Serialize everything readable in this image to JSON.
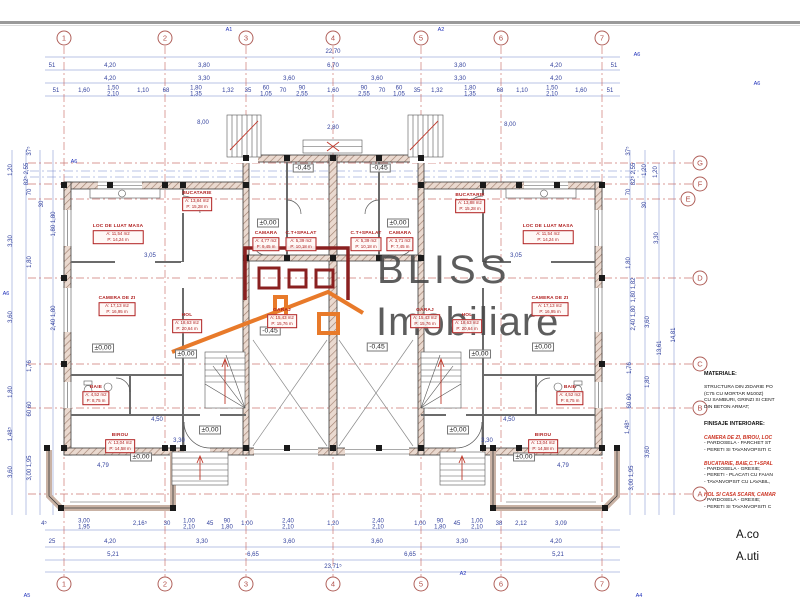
{
  "colors": {
    "grid_red": "#c4625c",
    "dim_blue": "#33429e",
    "label_red": "#b02020",
    "logo_orange": "#e87a2a",
    "logo_darkred": "#8a2020",
    "watermark_gray": "#474747"
  },
  "watermark": {
    "line1": "BLISS",
    "line2": "Imobiliare"
  },
  "grid": {
    "top_y": 38,
    "bottom_y": 584,
    "right_x": 700,
    "cols": [
      {
        "n": "1",
        "x": 64
      },
      {
        "n": "2",
        "x": 165
      },
      {
        "n": "3",
        "x": 246
      },
      {
        "n": "4",
        "x": 333
      },
      {
        "n": "5",
        "x": 421
      },
      {
        "n": "6",
        "x": 501
      },
      {
        "n": "7",
        "x": 602
      }
    ],
    "rows": [
      {
        "n": "G",
        "y": 163
      },
      {
        "n": "F",
        "y": 184
      },
      {
        "n": "E",
        "y": 199,
        "bx": 688
      },
      {
        "n": "D",
        "y": 278
      },
      {
        "n": "C",
        "y": 364
      },
      {
        "n": "B",
        "y": 408
      },
      {
        "n": "A",
        "y": 494
      }
    ]
  },
  "rooms": [
    {
      "name": "BUCATARIE",
      "a": "A: 13,84 m2",
      "p": "P: 15,28 m",
      "x": 197,
      "y": 201
    },
    {
      "name": "BUCATARIE",
      "a": "A: 13,88 m2",
      "p": "P: 15,28 m",
      "x": 470,
      "y": 203
    },
    {
      "name": "LOC DE LUAT MASA",
      "a": "A: 11,54 m2",
      "p": "P: 14,24 m",
      "x": 118,
      "y": 234
    },
    {
      "name": "LOC DE LUAT MASA",
      "a": "A: 11,54 m2",
      "p": "P: 14,24 m",
      "x": 548,
      "y": 234
    },
    {
      "name": "CAMARA",
      "a": "A: 4,77 m2",
      "p": "P: 9,45 m",
      "x": 266,
      "y": 241
    },
    {
      "name": "C.T+SPALAT",
      "a": "A: 5,39 m2",
      "p": "P: 10,18 m",
      "x": 301,
      "y": 241
    },
    {
      "name": "C.T+SPALAT",
      "a": "A: 5,39 m2",
      "p": "P: 10,18 m",
      "x": 366,
      "y": 241
    },
    {
      "name": "CAMARA",
      "a": "A: 3,71 m2",
      "p": "P: 7,45 m",
      "x": 400,
      "y": 241
    },
    {
      "name": "CAMERA DE ZI",
      "a": "A: 17,13 m2",
      "p": "P: 16,95 m",
      "x": 117,
      "y": 306
    },
    {
      "name": "CAMERA DE ZI",
      "a": "A: 17,13 m2",
      "p": "P: 16,95 m",
      "x": 550,
      "y": 306
    },
    {
      "name": "HOL",
      "a": "A: 18,63 m2",
      "p": "P: 20,64 m",
      "x": 187,
      "y": 323
    },
    {
      "name": "HOL",
      "a": "A: 18,63 m2",
      "p": "P: 20,64 m",
      "x": 467,
      "y": 323
    },
    {
      "name": "GARAJ",
      "a": "A: 15,43 m2",
      "p": "P: 15,76 m",
      "x": 282,
      "y": 318
    },
    {
      "name": "GARAJ",
      "a": "A: 15,43 m2",
      "p": "P: 15,76 m",
      "x": 425,
      "y": 318
    },
    {
      "name": "BAIE",
      "a": "A: 4,52 m2",
      "p": "P: 8,75 m",
      "x": 96,
      "y": 395
    },
    {
      "name": "BAIE",
      "a": "A: 4,52 m2",
      "p": "P: 8,75 m",
      "x": 570,
      "y": 395
    },
    {
      "name": "BIROU",
      "a": "A: 13,04 m2",
      "p": "P: 14,58 m",
      "x": 120,
      "y": 443
    },
    {
      "name": "BIROU",
      "a": "A: 13,04 m2",
      "p": "P: 14,58 m",
      "x": 543,
      "y": 443
    }
  ],
  "elevations": [
    {
      "t": "±0,00",
      "x": 103,
      "y": 348
    },
    {
      "t": "±0,00",
      "x": 186,
      "y": 354
    },
    {
      "t": "±0,00",
      "x": 543,
      "y": 347
    },
    {
      "t": "±0,00",
      "x": 480,
      "y": 354
    },
    {
      "t": "±0,00",
      "x": 268,
      "y": 223
    },
    {
      "t": "±0,00",
      "x": 398,
      "y": 223
    },
    {
      "t": "±0,00",
      "x": 210,
      "y": 430
    },
    {
      "t": "±0,00",
      "x": 458,
      "y": 430
    },
    {
      "t": "±0,00",
      "x": 141,
      "y": 457
    },
    {
      "t": "±0,00",
      "x": 524,
      "y": 457
    },
    {
      "t": "-0,45",
      "x": 303,
      "y": 168
    },
    {
      "t": "-0,45",
      "x": 380,
      "y": 168
    },
    {
      "t": "-0,45",
      "x": 270,
      "y": 331
    },
    {
      "t": "-0,45",
      "x": 377,
      "y": 347
    }
  ],
  "dimensions": [
    {
      "x": 333,
      "y": 52,
      "t": "22,70"
    },
    {
      "x": 52,
      "y": 66,
      "t": "51"
    },
    {
      "x": 110,
      "y": 66,
      "t": "4,20"
    },
    {
      "x": 204,
      "y": 66,
      "t": "3,80"
    },
    {
      "x": 333,
      "y": 66,
      "t": "6,70"
    },
    {
      "x": 460,
      "y": 66,
      "t": "3,80"
    },
    {
      "x": 556,
      "y": 66,
      "t": "4,20"
    },
    {
      "x": 614,
      "y": 66,
      "t": "51"
    },
    {
      "x": 110,
      "y": 79,
      "t": "4,20"
    },
    {
      "x": 204,
      "y": 79,
      "t": "3,30"
    },
    {
      "x": 289,
      "y": 79,
      "t": "3,60"
    },
    {
      "x": 377,
      "y": 79,
      "t": "3,60"
    },
    {
      "x": 460,
      "y": 79,
      "t": "3,30"
    },
    {
      "x": 556,
      "y": 79,
      "t": "4,20"
    },
    {
      "x": 56,
      "y": 91,
      "t": "51"
    },
    {
      "x": 84,
      "y": 91,
      "t": "1,60"
    },
    {
      "x": 113,
      "y": 92,
      "t": "1,50\n2,10"
    },
    {
      "x": 143,
      "y": 91,
      "t": "1,10"
    },
    {
      "x": 166,
      "y": 91,
      "t": "68"
    },
    {
      "x": 196,
      "y": 92,
      "t": "1,80\n1,35"
    },
    {
      "x": 228,
      "y": 91,
      "t": "1,32"
    },
    {
      "x": 248,
      "y": 91,
      "t": "35"
    },
    {
      "x": 266,
      "y": 92,
      "t": "60\n1,05"
    },
    {
      "x": 283,
      "y": 91,
      "t": "70"
    },
    {
      "x": 302,
      "y": 92,
      "t": "90\n2,55"
    },
    {
      "x": 333,
      "y": 91,
      "t": "1,60"
    },
    {
      "x": 364,
      "y": 92,
      "t": "90\n2,55"
    },
    {
      "x": 382,
      "y": 91,
      "t": "70"
    },
    {
      "x": 399,
      "y": 92,
      "t": "60\n1,05"
    },
    {
      "x": 417,
      "y": 91,
      "t": "35"
    },
    {
      "x": 437,
      "y": 91,
      "t": "1,32"
    },
    {
      "x": 470,
      "y": 92,
      "t": "1,80\n1,35"
    },
    {
      "x": 500,
      "y": 91,
      "t": "68"
    },
    {
      "x": 522,
      "y": 91,
      "t": "1,10"
    },
    {
      "x": 552,
      "y": 92,
      "t": "1,50\n2,10"
    },
    {
      "x": 581,
      "y": 91,
      "t": "1,60"
    },
    {
      "x": 610,
      "y": 91,
      "t": "51"
    },
    {
      "x": 203,
      "y": 123,
      "t": "8,00"
    },
    {
      "x": 510,
      "y": 125,
      "t": "8,00"
    },
    {
      "x": 333,
      "y": 128,
      "t": "2,80"
    },
    {
      "x": 150,
      "y": 256,
      "t": "3,05"
    },
    {
      "x": 516,
      "y": 256,
      "t": "3,05"
    },
    {
      "x": 157,
      "y": 420,
      "t": "4,50"
    },
    {
      "x": 509,
      "y": 420,
      "t": "4,50"
    },
    {
      "x": 179,
      "y": 441,
      "t": "3,30"
    },
    {
      "x": 487,
      "y": 441,
      "t": "3,30"
    },
    {
      "x": 103,
      "y": 466,
      "t": "4,79"
    },
    {
      "x": 563,
      "y": 466,
      "t": "4,79"
    },
    {
      "x": 44,
      "y": 524,
      "t": "4⁵"
    },
    {
      "x": 84,
      "y": 525,
      "t": "3,00\n1,95"
    },
    {
      "x": 140,
      "y": 524,
      "t": "2,16⁵"
    },
    {
      "x": 167,
      "y": 524,
      "t": "30"
    },
    {
      "x": 189,
      "y": 525,
      "t": "1,00\n2,10"
    },
    {
      "x": 210,
      "y": 524,
      "t": "45"
    },
    {
      "x": 227,
      "y": 525,
      "t": "90\n1,80"
    },
    {
      "x": 247,
      "y": 524,
      "t": "1,00"
    },
    {
      "x": 288,
      "y": 525,
      "t": "2,40\n2,10"
    },
    {
      "x": 333,
      "y": 524,
      "t": "1,20"
    },
    {
      "x": 378,
      "y": 525,
      "t": "2,40\n2,10"
    },
    {
      "x": 420,
      "y": 524,
      "t": "1,00"
    },
    {
      "x": 440,
      "y": 525,
      "t": "90\n1,80"
    },
    {
      "x": 457,
      "y": 524,
      "t": "45"
    },
    {
      "x": 477,
      "y": 525,
      "t": "1,00\n2,10"
    },
    {
      "x": 499,
      "y": 524,
      "t": "38"
    },
    {
      "x": 521,
      "y": 524,
      "t": "2,12"
    },
    {
      "x": 561,
      "y": 524,
      "t": "3,09"
    },
    {
      "x": 52,
      "y": 542,
      "t": "25"
    },
    {
      "x": 110,
      "y": 542,
      "t": "4,20"
    },
    {
      "x": 202,
      "y": 542,
      "t": "3,30"
    },
    {
      "x": 289,
      "y": 542,
      "t": "3,60"
    },
    {
      "x": 377,
      "y": 542,
      "t": "3,60"
    },
    {
      "x": 462,
      "y": 542,
      "t": "3,30"
    },
    {
      "x": 556,
      "y": 542,
      "t": "4,20"
    },
    {
      "x": 113,
      "y": 555,
      "t": "5,21"
    },
    {
      "x": 253,
      "y": 555,
      "t": "6,65"
    },
    {
      "x": 410,
      "y": 555,
      "t": "6,65"
    },
    {
      "x": 558,
      "y": 555,
      "t": "5,21"
    },
    {
      "x": 333,
      "y": 567,
      "t": "23,71⁵"
    },
    {
      "x": 30,
      "y": 151,
      "t": "37⁵",
      "r": 1
    },
    {
      "x": 27,
      "y": 174,
      "t": "82⁵ 2,55",
      "r": 1
    },
    {
      "x": 11,
      "y": 170,
      "t": "1,20",
      "r": 1
    },
    {
      "x": 30,
      "y": 192,
      "t": "70",
      "r": 1
    },
    {
      "x": 42,
      "y": 204,
      "t": "30",
      "r": 1
    },
    {
      "x": 54,
      "y": 224,
      "t": "1,80 1,80",
      "r": 1
    },
    {
      "x": 11,
      "y": 241,
      "t": "3,30",
      "r": 1
    },
    {
      "x": 30,
      "y": 262,
      "t": "1,80",
      "r": 1
    },
    {
      "x": 54,
      "y": 318,
      "t": "2,40 1,80",
      "r": 1
    },
    {
      "x": 11,
      "y": 317,
      "t": "3,60",
      "r": 1
    },
    {
      "x": 30,
      "y": 366,
      "t": "1,76",
      "r": 1
    },
    {
      "x": 11,
      "y": 392,
      "t": "1,80",
      "r": 1
    },
    {
      "x": 30,
      "y": 409,
      "t": "60 60",
      "r": 1
    },
    {
      "x": 11,
      "y": 434,
      "t": "1,48⁵",
      "r": 1
    },
    {
      "x": 30,
      "y": 468,
      "t": "3,00 1,95",
      "r": 1
    },
    {
      "x": 11,
      "y": 472,
      "t": "3,60",
      "r": 1
    },
    {
      "x": 629,
      "y": 151,
      "t": "37⁵",
      "r": 1
    },
    {
      "x": 634,
      "y": 174,
      "t": "82⁵ 2,55",
      "r": 1
    },
    {
      "x": 645,
      "y": 170,
      "t": "1,20",
      "r": 1
    },
    {
      "x": 656,
      "y": 172,
      "t": "1,20",
      "r": 1
    },
    {
      "x": 629,
      "y": 192,
      "t": "70",
      "r": 1
    },
    {
      "x": 645,
      "y": 205,
      "t": "30",
      "r": 1
    },
    {
      "x": 634,
      "y": 290,
      "t": "1,80 1,82",
      "r": 1
    },
    {
      "x": 657,
      "y": 238,
      "t": "3,30",
      "r": 1
    },
    {
      "x": 629,
      "y": 263,
      "t": "1,80",
      "r": 1
    },
    {
      "x": 634,
      "y": 318,
      "t": "2,40 1,80",
      "r": 1
    },
    {
      "x": 648,
      "y": 322,
      "t": "3,60",
      "r": 1
    },
    {
      "x": 660,
      "y": 348,
      "t": "13,61",
      "r": 1
    },
    {
      "x": 674,
      "y": 335,
      "t": "14,81",
      "r": 1
    },
    {
      "x": 630,
      "y": 368,
      "t": "1,76",
      "r": 1
    },
    {
      "x": 648,
      "y": 382,
      "t": "1,80",
      "r": 1
    },
    {
      "x": 630,
      "y": 401,
      "t": "60 60",
      "r": 1
    },
    {
      "x": 628,
      "y": 427,
      "t": "1,48⁵",
      "r": 1
    },
    {
      "x": 648,
      "y": 452,
      "t": "3,60",
      "r": 1
    },
    {
      "x": 632,
      "y": 478,
      "t": "3,00 1,95",
      "r": 1
    }
  ],
  "flags": [
    {
      "t": "A1",
      "x": 229,
      "y": 30
    },
    {
      "t": "A2",
      "x": 441,
      "y": 30
    },
    {
      "t": "A6",
      "x": 74,
      "y": 162
    },
    {
      "t": "A6",
      "x": 637,
      "y": 55
    },
    {
      "t": "A6",
      "x": 757,
      "y": 84
    },
    {
      "t": "A6",
      "x": 6,
      "y": 294
    },
    {
      "t": "A5",
      "x": 27,
      "y": 596
    },
    {
      "t": "A2",
      "x": 463,
      "y": 574
    },
    {
      "t": "A4",
      "x": 639,
      "y": 596
    }
  ],
  "notes": {
    "materiale_title": "MATERIALE:",
    "materiale_lines": [
      "STRUCTURA DIN ZIDARIE PO",
      "(C75 CU MORTAR M100Z)",
      "CU SAMBURI, GRINZI SI CENT",
      "DIN BETON ARMAT;"
    ],
    "finisaje_title": "FINISAJE INTERIOARE:",
    "sections": [
      {
        "title": "CAMERA DE ZI, BIROU, LOC",
        "lines": [
          "- PARDOSELA - PARCHET ST",
          "- PERETI SI TAVANVOPSITI C"
        ]
      },
      {
        "title": "BUCATARIE, BAIE,C.T+SPAL",
        "lines": [
          "- PARDOSELA - GRESIE;",
          "- PERETI - PLACATI CU FAIAN",
          "- TAVANVOPSIT CU LAVABIL,"
        ]
      },
      {
        "title": "HOL SI CASA SCARII, CAMAR",
        "lines": [
          "- PARDOSELA - GRESIE;",
          "- PERETI SI TAVANVOPSITI C"
        ]
      }
    ]
  },
  "areas": {
    "line1": "A.co",
    "line2": "A.uti"
  }
}
